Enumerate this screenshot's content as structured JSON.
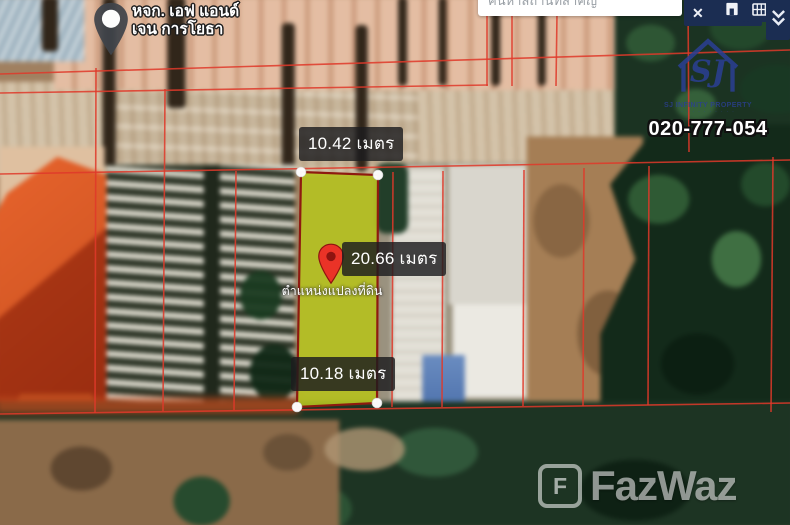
{
  "poi": {
    "name_line1": "หจก. เอฟ แอนด์",
    "name_line2": "เจน การโยธา"
  },
  "search": {
    "placeholder": "ค้นหาสถานที่สำคัญ",
    "close_label": "✕"
  },
  "plot": {
    "top_width": "10.42 เมตร",
    "length": "20.66 เมตร",
    "bottom_width": "10.18 เมตร",
    "caption": "ตำแหน่งแปลงที่ดิน"
  },
  "agency": {
    "monogram": "SJ",
    "name": "SJ INFINITY PROPERTY",
    "tagline": "· · · · · · · · · ·",
    "phone": "020-777-054"
  },
  "watermark": {
    "mark": "F",
    "brand": "FazWaz"
  },
  "colors": {
    "cadastral": "#e0392a",
    "plot_fill": "#b5c41f",
    "plot_border": "#8e1a10",
    "pin_red": "#ea3327",
    "navy_button": "#1b2d52",
    "logo_blue": "#2b3f94"
  }
}
